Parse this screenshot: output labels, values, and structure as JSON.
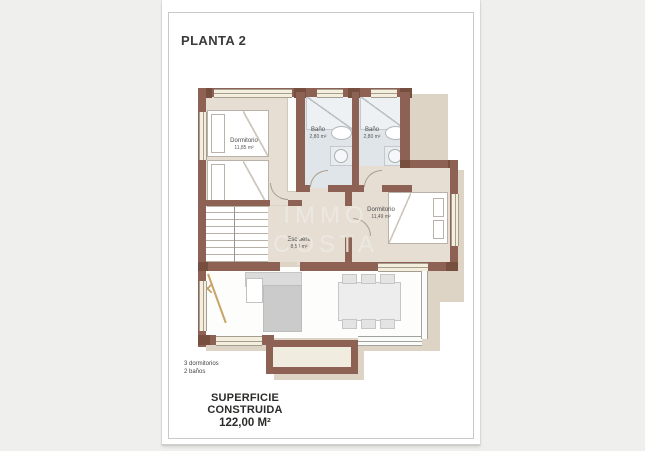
{
  "document": {
    "title": "PLANTA 2",
    "watermark": [
      "IMMO",
      "COSTA"
    ],
    "summary": {
      "line1": "3 dormitorios",
      "line2": "2 baños"
    },
    "footer": {
      "label": "SUPERFICIE CONSTRUIDA",
      "value": "122,00 M²"
    }
  },
  "rooms": {
    "dormitorio1": {
      "name": "Dormitorio",
      "area": "11,85 m²"
    },
    "bano1": {
      "name": "Baño",
      "area": "2,80 m²"
    },
    "bano2": {
      "name": "Baño",
      "area": "2,80 m²"
    },
    "dormitorio2": {
      "name": "Dormitorio",
      "area": "11,49 m²"
    },
    "escalera": {
      "name": "Escalera",
      "area": "8,50 m²"
    }
  },
  "colors": {
    "wall": "#8d6154",
    "wall_dark": "#774f3f",
    "beige": "#e6ddd3",
    "bath": "#dfe5e9",
    "cream": "#f4eedd",
    "white_floor": "#fdfdfb",
    "balcony": "#f1ece0",
    "shadow": "#ddd4c6",
    "line": "#a49e92",
    "tan": "#c9a469",
    "watermark": "#eceae3"
  }
}
